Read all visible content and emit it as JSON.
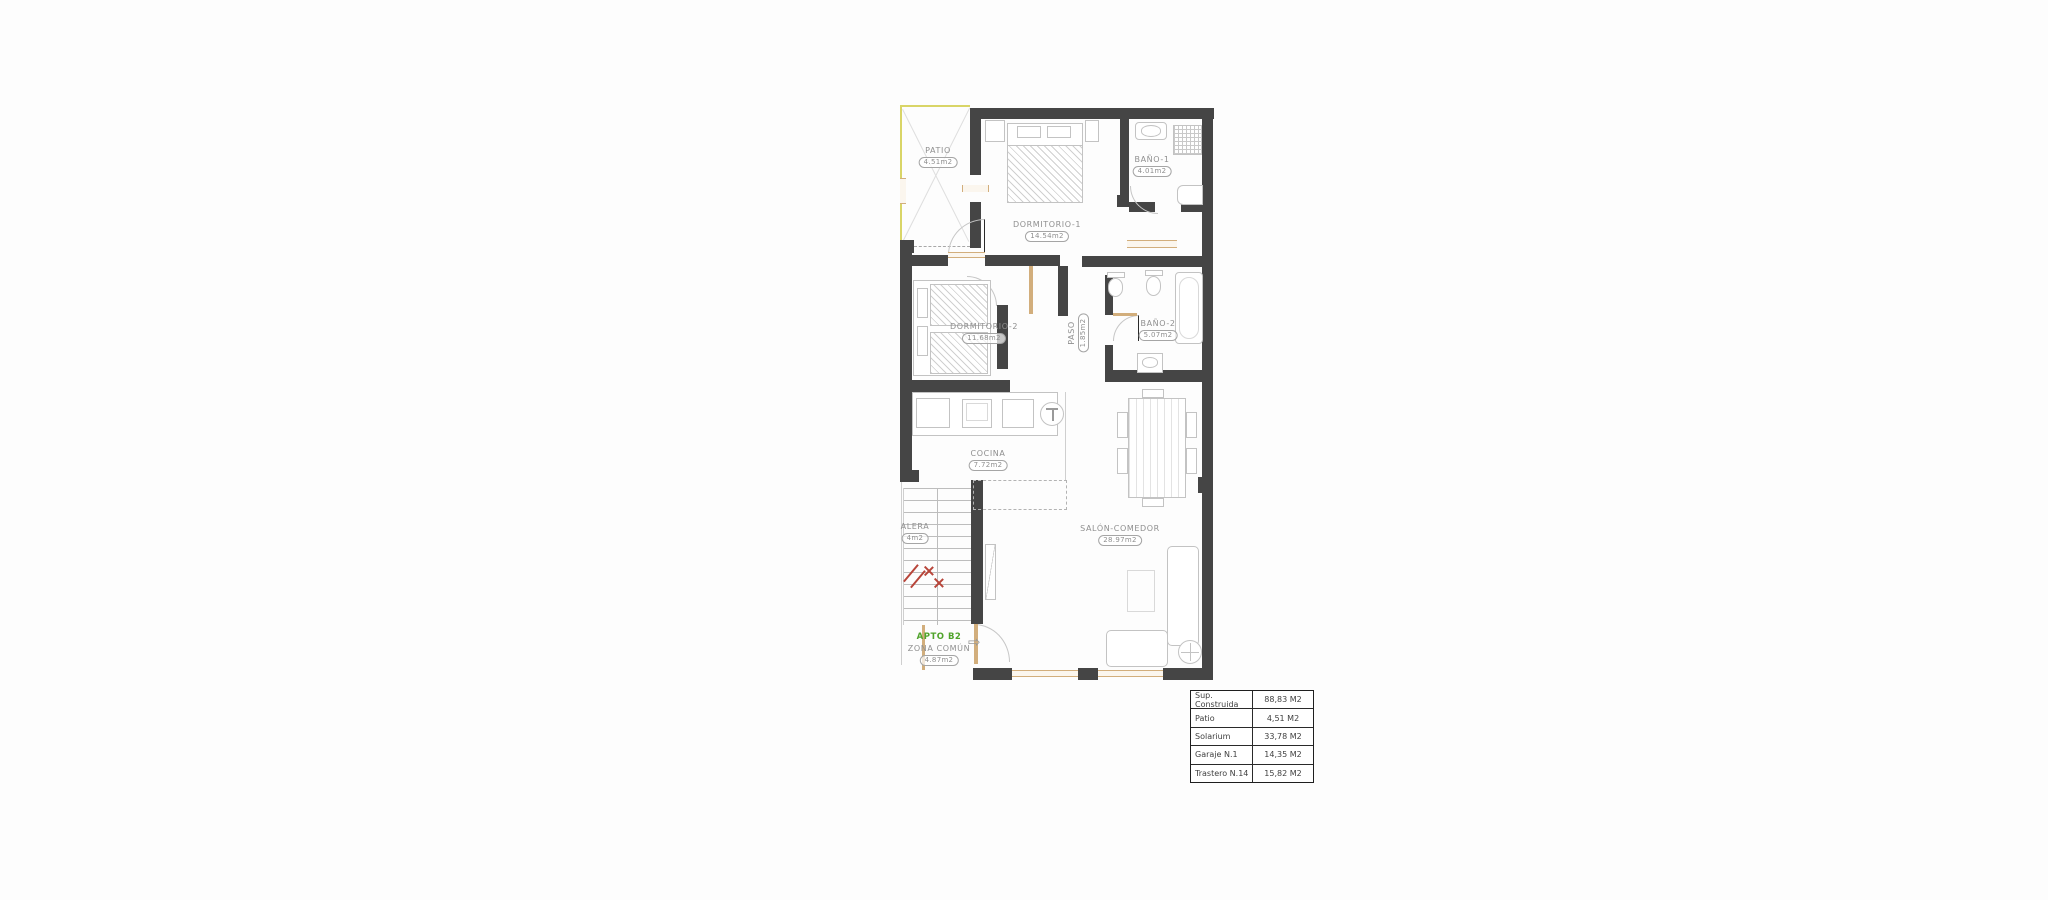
{
  "plan": {
    "rooms": [
      {
        "id": "patio",
        "name": "PATIO",
        "area": "4.51m2"
      },
      {
        "id": "dormitorio-1",
        "name": "DORMITORIO-1",
        "area": "14.54m2"
      },
      {
        "id": "bano-1",
        "name": "BAÑO-1",
        "area": "4.01m2"
      },
      {
        "id": "dormitorio-2",
        "name": "DORMITORIO-2",
        "area": "11.68m2"
      },
      {
        "id": "paso",
        "name": "PASO",
        "area": "1.85m2"
      },
      {
        "id": "bano-2",
        "name": "BAÑO-2",
        "area": "5.07m2"
      },
      {
        "id": "cocina",
        "name": "COCINA",
        "area": "7.72m2"
      },
      {
        "id": "salon",
        "name": "SALÓN-COMEDOR",
        "area": "28.97m2"
      },
      {
        "id": "escalera",
        "name": "ALERA",
        "area": "4m2"
      }
    ],
    "apartment_label": "APTO B2",
    "common_zone_label": "ZONA COMÚN",
    "common_zone_area": "4.87m2",
    "colors": {
      "wall": "#454545",
      "apartment_green": "#4fa32a",
      "warning_red": "#b8453a",
      "wood_tan": "#d2ae7c",
      "patio_yellow": "#d9d567"
    }
  },
  "summary_table": {
    "rows": [
      {
        "label": "Sup. Construida",
        "value": "88,83 M2"
      },
      {
        "label": "Patio",
        "value": "4,51 M2"
      },
      {
        "label": "Solarium",
        "value": "33,78 M2"
      },
      {
        "label": "Garaje  N.1",
        "value": "14,35 M2"
      },
      {
        "label": "Trastero N.14",
        "value": "15,82 M2"
      }
    ]
  }
}
